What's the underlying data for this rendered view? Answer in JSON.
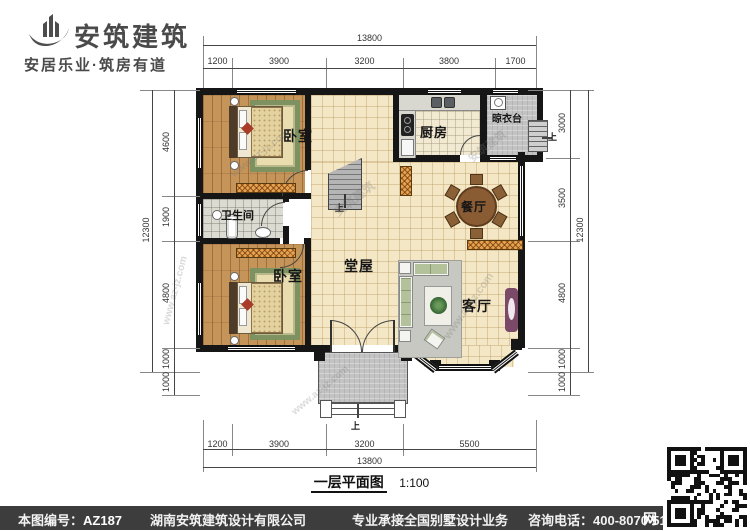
{
  "brand": {
    "name": "安筑建筑",
    "slogan": "安居乐业·筑房有道"
  },
  "plan": {
    "title": "一层平面图",
    "scale": "1:100",
    "rooms": {
      "bedroom_top": "卧室",
      "kitchen": "厨房",
      "drying_balcony": "晾衣台",
      "dining": "餐厅",
      "bathroom": "卫生间",
      "bedroom_bottom": "卧室",
      "hall": "堂屋",
      "living": "客厅"
    },
    "up_label": "上",
    "dims": {
      "top": {
        "total": "13800",
        "segments": [
          "1200",
          "3900",
          "3200",
          "3800",
          "1700"
        ]
      },
      "bottom": {
        "total": "13800",
        "segments": [
          "1200",
          "3900",
          "3200",
          "5500"
        ]
      },
      "left": {
        "total": "12300",
        "segments": [
          "4600",
          "1900",
          "4800",
          "1000"
        ],
        "extra": "1000"
      },
      "right": {
        "total": "12300",
        "segments": [
          "3000",
          "3500",
          "4800",
          "1000"
        ],
        "extra": "1000"
      }
    }
  },
  "watermark": {
    "brand": "安筑建筑",
    "site": "www.az-jz.com"
  },
  "footer": {
    "drawing_no_label": "本图编号：",
    "drawing_no": "AZ187",
    "company": "湖南安筑建筑设计有限公司",
    "service": "专业承接全国别墅设计业务",
    "phone_label": "咨询电话：",
    "phone": "400-8070-511",
    "net": "网"
  },
  "colors": {
    "wall": "#161616",
    "footer_bg": "#3d3d3d",
    "tile": "#f4e7c5",
    "hatch": "#e6a34f"
  }
}
